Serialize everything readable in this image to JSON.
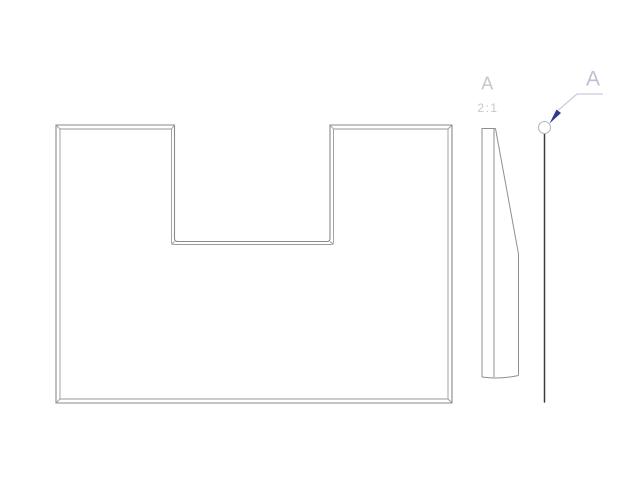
{
  "drawing": {
    "type": "cad-technical-drawing",
    "background": "#ffffff",
    "section_view": {
      "label": "A",
      "scale": "2:1"
    },
    "section_cut": {
      "label": "A"
    },
    "colors": {
      "plate_outline": "#8a8a8a",
      "plate_inner_edge": "#9a9a9a",
      "profile_outline": "#8f8f8f",
      "section_line": "#3a3a3a",
      "cut_circle": "#b6b6bd",
      "leader_line": "#c8cbdc",
      "arrowhead": "#2e3b8c",
      "label_gray": "#c6c6cb",
      "label_blue_gray": "#bcc0d2"
    }
  }
}
